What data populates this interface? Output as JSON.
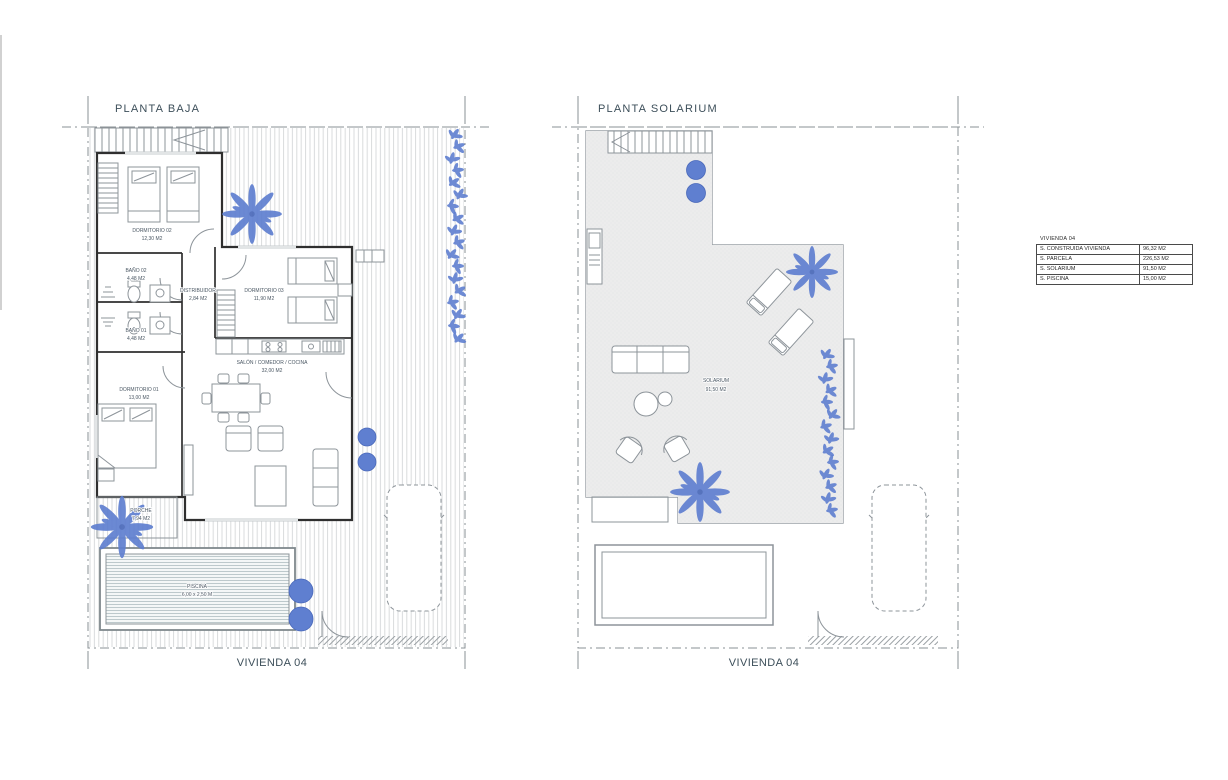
{
  "colors": {
    "accent_blue": "#5f7fd0",
    "title_text": "#3d4f5a",
    "label_text": "#4a5763",
    "wall": "#2f2f2f",
    "line": "#8d949a",
    "boundary": "#8a9094",
    "solarium_fill": "#ececec",
    "pool_stripe": "#b7c4c8",
    "table_border": "#4a4a4a",
    "table_text": "#2b2b2b"
  },
  "plans": {
    "baja": {
      "title": "PLANTA BAJA",
      "footer": "VIVIENDA 04",
      "rooms": [
        {
          "name": "DORMITORIO 02",
          "area": "12,30 M2"
        },
        {
          "name": "BAÑO 02",
          "area": "4,48 M2"
        },
        {
          "name": "BAÑO 01",
          "area": "4,48 M2"
        },
        {
          "name": "DISTRIBUIDOR",
          "area": "2,84 M2"
        },
        {
          "name": "DORMITORIO 03",
          "area": "11,90 M2"
        },
        {
          "name": "SALÓN / COMEDOR / COCINA",
          "area": "32,00 M2"
        },
        {
          "name": "DORMITORIO 01",
          "area": "13,00 M2"
        },
        {
          "name": "PORCHE",
          "area": "7,94 M2"
        }
      ],
      "pool": {
        "name": "PISCINA",
        "dims": "6,00 x 2,50 M"
      }
    },
    "solarium": {
      "title": "PLANTA SOLARIUM",
      "footer": "VIVIENDA 04",
      "rooms": [
        {
          "name": "SOLARIUM",
          "area": "91,50 M2"
        }
      ]
    }
  },
  "summary_table": {
    "title": "VIVIENDA 04",
    "rows": [
      {
        "label": "S. CONSTRUIDA VIVIENDA",
        "value": "96,32 M2"
      },
      {
        "label": "S. PARCELA",
        "value": "226,53 M2"
      },
      {
        "label": "S. SOLARIUM",
        "value": "91,50 M2"
      },
      {
        "label": "S. PISCINA",
        "value": "15,00 M2"
      }
    ]
  }
}
